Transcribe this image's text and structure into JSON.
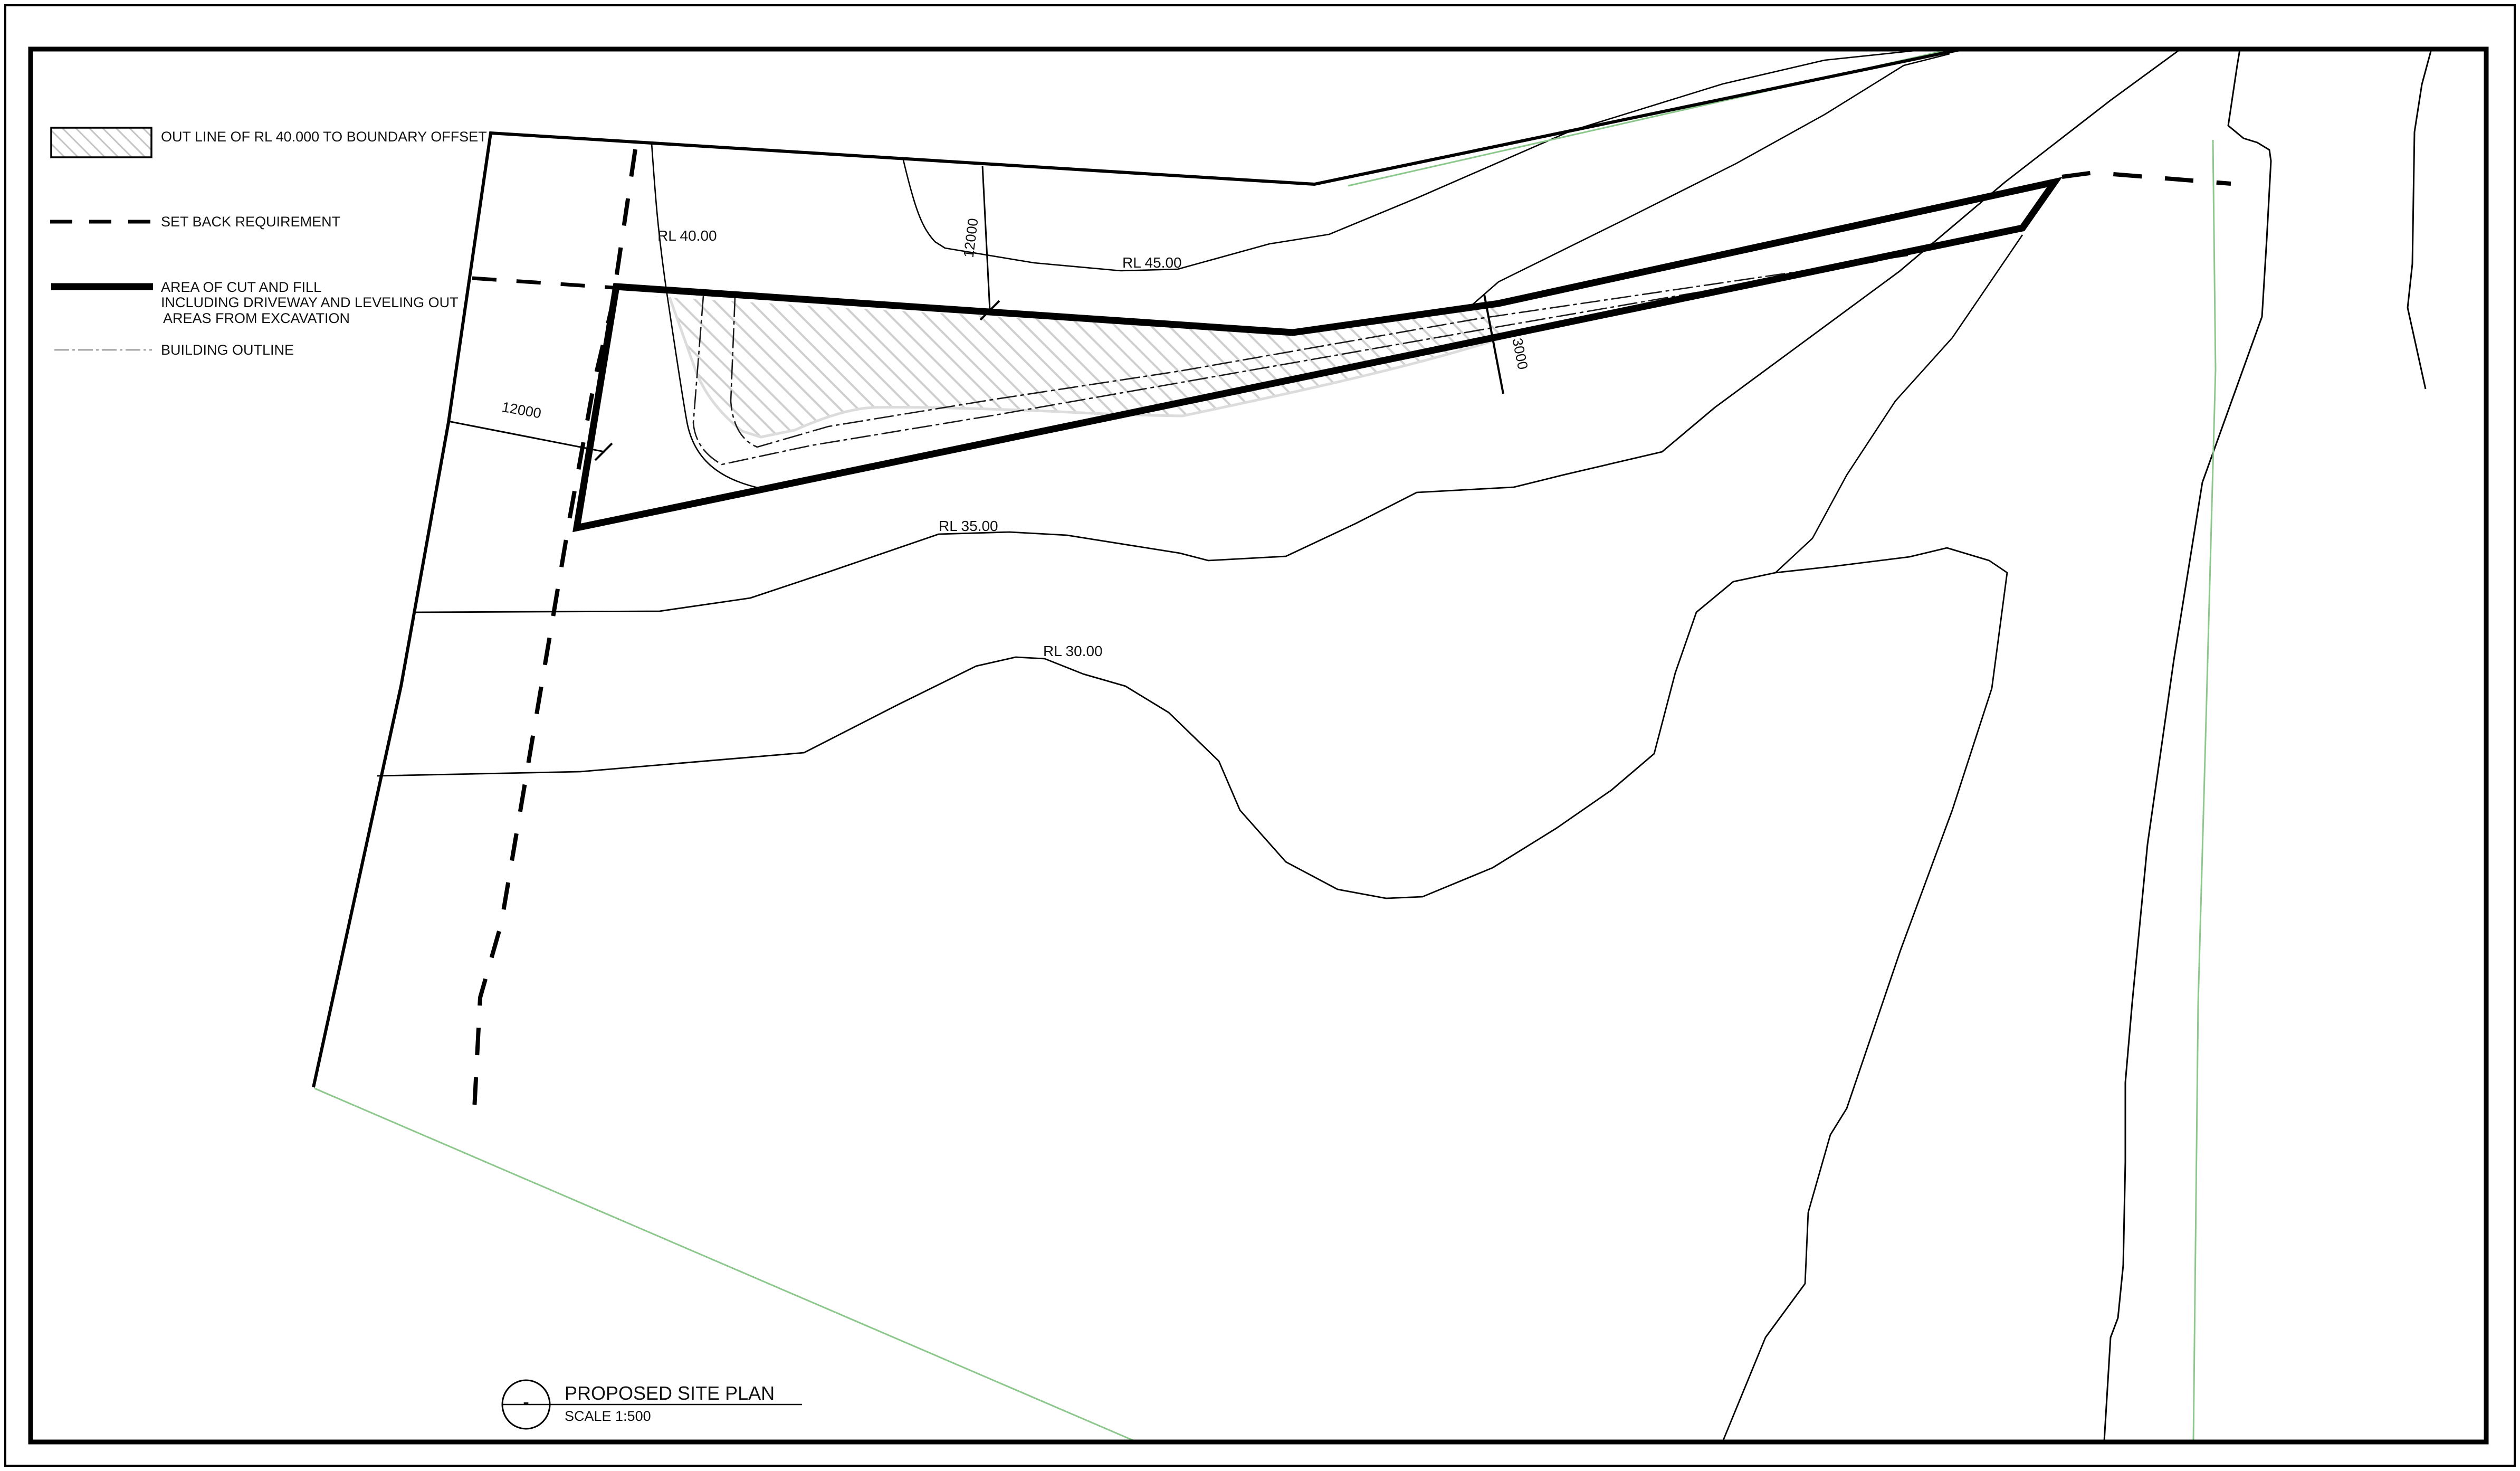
{
  "legend": {
    "items": [
      {
        "key": "rl40-offset",
        "label": "OUT LINE OF RL 40.000 TO BOUNDARY OFFSET",
        "symbol": "hatched-box"
      },
      {
        "key": "setback",
        "label": "SET BACK REQUIREMENT",
        "symbol": "dashed-line"
      },
      {
        "key": "cut-fill",
        "label_lines": [
          "AREA OF CUT AND FILL",
          "INCLUDING DRIVEWAY AND LEVELING OUT",
          "AREAS FROM EXCAVATION"
        ],
        "symbol": "thick-line"
      },
      {
        "key": "building-outline",
        "label": "BUILDING OUTLINE",
        "symbol": "thin-dashdot-line"
      }
    ]
  },
  "contour_labels": {
    "rl40": "RL 40.00",
    "rl45": "RL 45.00",
    "rl35": "RL 35.00",
    "rl30": "RL 30.00"
  },
  "dimensions": {
    "top_offset": "12000",
    "left_offset": "12000",
    "corridor_width": "3000"
  },
  "title_block": {
    "symbol": "-",
    "title": "PROPOSED SITE PLAN",
    "scale": "SCALE 1:500"
  },
  "colors": {
    "line_black": "#000000",
    "vegetation_green": "#8cc88c",
    "hatch_gray": "#cfcfcf",
    "hatch_edge_gray": "#dcdcdc",
    "thin_sample_gray": "#949494"
  }
}
